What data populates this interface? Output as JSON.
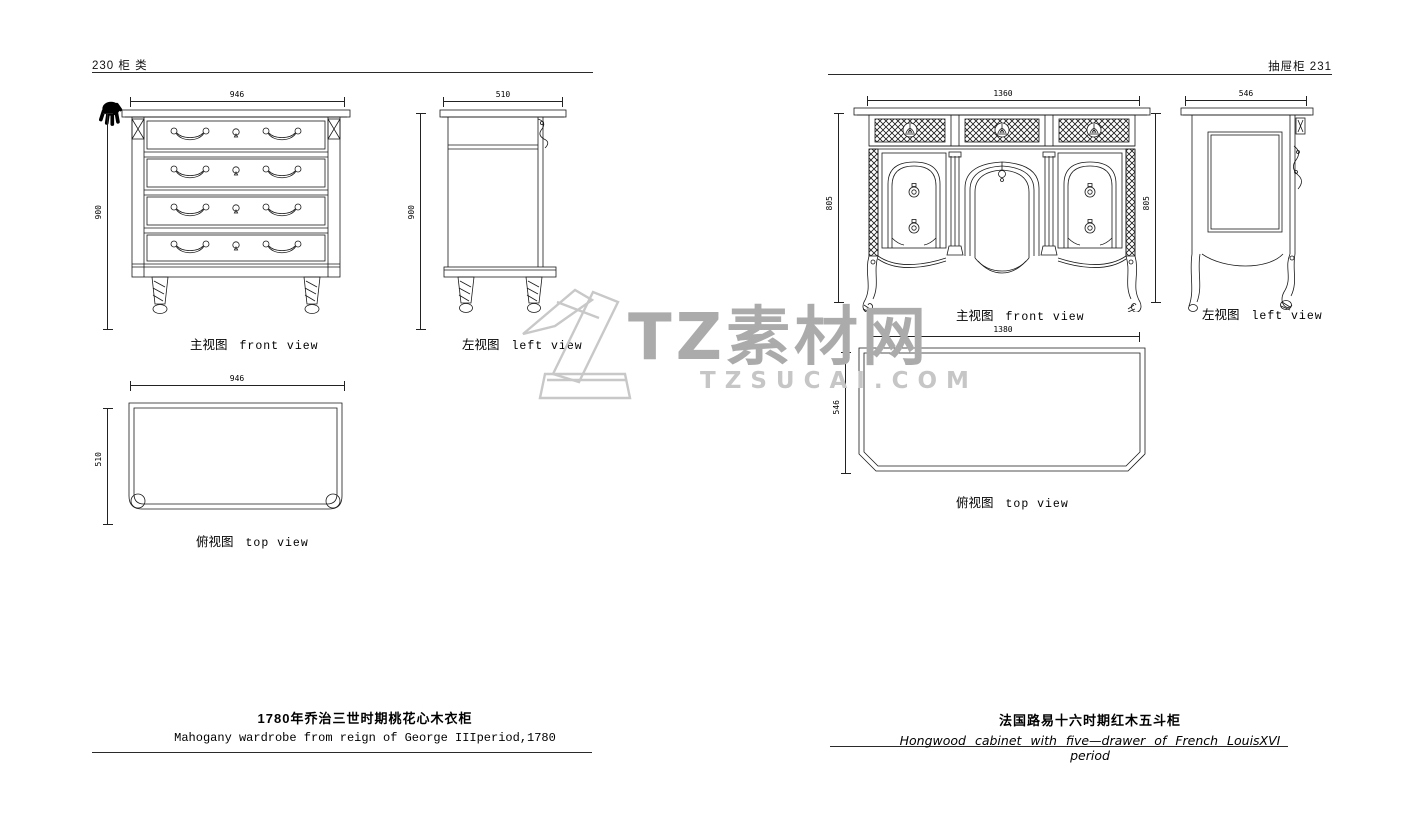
{
  "header": {
    "left": "230 柜 类",
    "right": "抽屉柜  231"
  },
  "watermark": {
    "brand": "TZ素材网",
    "site": "TZSUCAI.COM"
  },
  "left_item": {
    "front_label_cn": "主视图",
    "front_label_en": "front view",
    "side_label_cn": "左视图",
    "side_label_en": "left view",
    "top_label_cn": "俯视图",
    "top_label_en": "top view",
    "front_width": "946",
    "front_height": "900",
    "side_width": "510",
    "side_height": "900",
    "top_width": "946",
    "top_depth": "510",
    "caption_cn": "1780年乔治三世时期桃花心木衣柜",
    "caption_en": "Mahogany wardrobe from reign of George IIIperiod,1780"
  },
  "right_item": {
    "front_label_cn": "主视图",
    "front_label_en": "front view",
    "side_label_cn": "左视图",
    "side_label_en": "left view",
    "top_label_cn": "俯视图",
    "top_label_en": "top view",
    "front_width": "1360",
    "front_height_left": "805",
    "front_height_right": "805",
    "side_width": "546",
    "top_width": "1380",
    "top_depth": "546",
    "caption_cn": "法国路易十六时期红木五斗柜",
    "caption_en": "Hongwood cabinet with five—drawer of French LouisXVI period"
  }
}
